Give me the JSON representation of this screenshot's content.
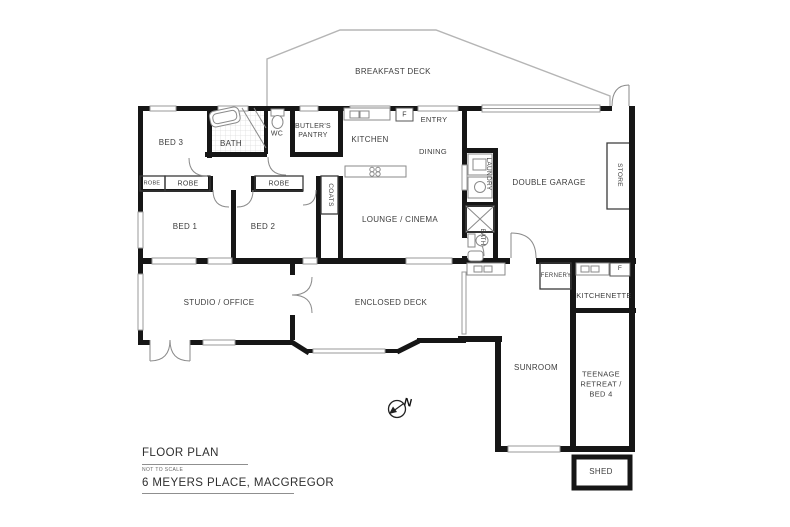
{
  "meta": {
    "background": "#ffffff",
    "wall_color": "#161616",
    "thin_line_color": "#9a9a9a",
    "label_color": "#3d3d3d"
  },
  "title_block": {
    "title": "FLOOR PLAN",
    "scale_note": "NOT TO SCALE",
    "address": "6 MEYERS PLACE, MACGREGOR"
  },
  "compass": {
    "label": "N"
  },
  "rooms": [
    {
      "id": "breakfast-deck",
      "label": "BREAKFAST DECK"
    },
    {
      "id": "bed-3",
      "label": "BED 3"
    },
    {
      "id": "bath",
      "label": "BATH"
    },
    {
      "id": "wc",
      "label": "WC"
    },
    {
      "id": "butlers-pantry",
      "label": "BUTLER'S PANTRY"
    },
    {
      "id": "kitchen",
      "label": "KITCHEN"
    },
    {
      "id": "fridge-kitchen",
      "label": "F"
    },
    {
      "id": "entry",
      "label": "ENTRY"
    },
    {
      "id": "dining",
      "label": "DINING"
    },
    {
      "id": "laundry",
      "label": "LAUNDRY"
    },
    {
      "id": "double-garage",
      "label": "DOUBLE GARAGE"
    },
    {
      "id": "store",
      "label": "STORE"
    },
    {
      "id": "robe-bed3",
      "label": "ROBE"
    },
    {
      "id": "robe-bed1",
      "label": "ROBE"
    },
    {
      "id": "robe-bed2",
      "label": "ROBE"
    },
    {
      "id": "coats",
      "label": "COATS"
    },
    {
      "id": "bed-1",
      "label": "BED 1"
    },
    {
      "id": "bed-2",
      "label": "BED 2"
    },
    {
      "id": "lounge-cinema",
      "label": "LOUNGE / CINEMA"
    },
    {
      "id": "bath-2",
      "label": "BATH"
    },
    {
      "id": "studio-office",
      "label": "STUDIO / OFFICE"
    },
    {
      "id": "enclosed-deck",
      "label": "ENCLOSED DECK"
    },
    {
      "id": "fernery",
      "label": "FERNERY"
    },
    {
      "id": "kitchenette",
      "label": "KITCHENETTE"
    },
    {
      "id": "fridge-kitchenette",
      "label": "F"
    },
    {
      "id": "sunroom",
      "label": "SUNROOM"
    },
    {
      "id": "teenage-retreat",
      "label": "TEENAGE RETREAT / BED 4"
    },
    {
      "id": "shed",
      "label": "SHED"
    }
  ]
}
